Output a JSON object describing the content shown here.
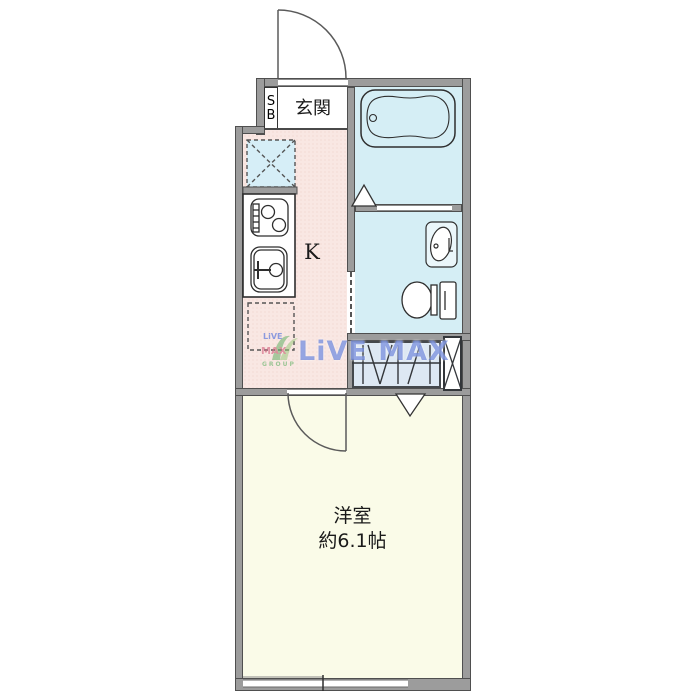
{
  "floorplan": {
    "type_note": "1K apartment floor plan",
    "rooms": {
      "entrance": {
        "label": "玄関"
      },
      "shoebox": {
        "letter_top": "S",
        "letter_bottom": "B"
      },
      "kitchen": {
        "label": "K"
      },
      "western_room": {
        "label": "洋室",
        "size": "約6.1帖"
      }
    },
    "fixtures": {
      "bathtub": "bathtub-icon",
      "toilet": "toilet-icon",
      "washbasin": "washbasin-icon",
      "stove": "stove-icon",
      "sink": "sink-icon",
      "washer_space": "washing-machine-space",
      "fridge_space": "refrigerator-space",
      "closet": "hanger-pipe-icon",
      "pipe_space": "ps-cross-icon",
      "window": "sliding-window",
      "doors": [
        "entrance-door-arc",
        "room-door-arc",
        "bath-door-triangle",
        "closet-door-triangle"
      ]
    },
    "colors": {
      "kitchen_floor": "#f9e7e3",
      "bath_floor": "#d5eef5",
      "western_room_floor": "#fafbe8",
      "closet_fill": "#dde8f3",
      "wall_fill": "#9c9c9c",
      "wall_edge": "#4f4f4f",
      "line": "#3c3c3c",
      "watermark_blue": "#3e5ecd"
    },
    "watermark": {
      "text": "LiVE MAX",
      "logo_top": "LiVE",
      "logo_mid": "MAX",
      "logo_bottom": "GROUP"
    }
  }
}
